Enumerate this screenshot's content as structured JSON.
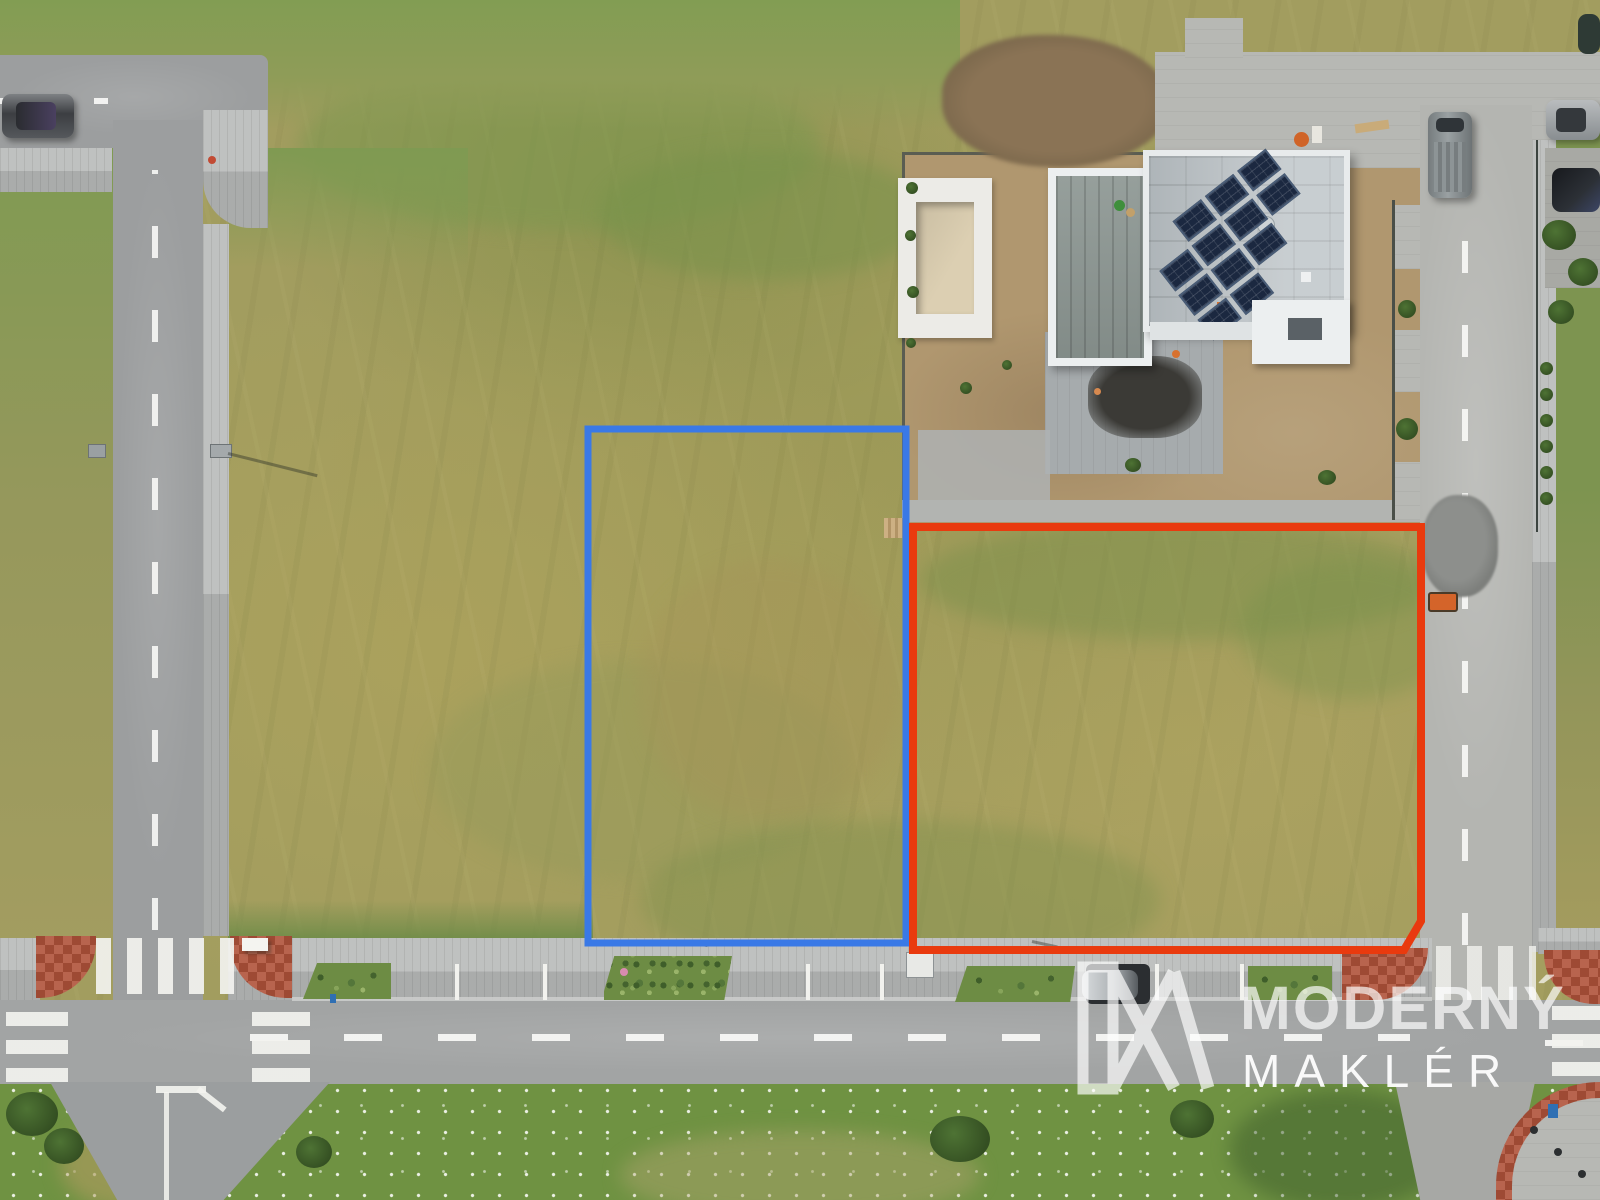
{
  "watermark": {
    "brand_top": "MODERNÝ",
    "brand_bottom": "MAKLÉR",
    "logo": "mx-house-monogram"
  },
  "annotations": {
    "plot_blue": {
      "shape": "rectangle",
      "color": "#3a79e6"
    },
    "plot_red": {
      "shape": "rectangle-chamfered-corner",
      "color": "#e93a0e"
    }
  },
  "palette": {
    "watermark": "#ffffff",
    "plot-blue": "#3a79e6",
    "plot-red": "#e93a0e",
    "brick-red": "#b0523a",
    "field-olive": "#a29d5f",
    "meadow-green": "#6f9242",
    "roof-gray": "#b9c0c4",
    "solar-navy": "#1b2840",
    "asphalt-gray": "#9c9e9f"
  }
}
